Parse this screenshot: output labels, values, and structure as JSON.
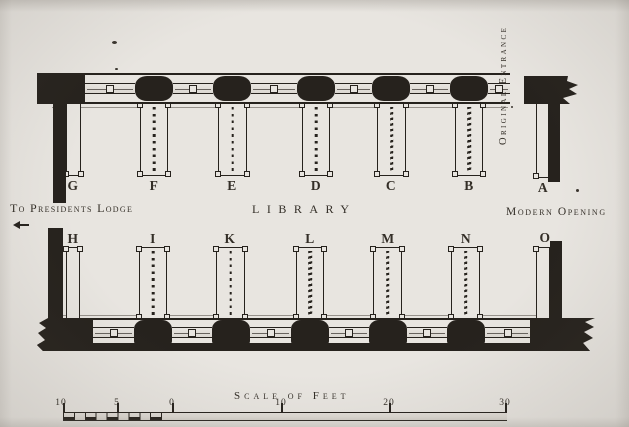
{
  "labels": {
    "original_entrance": "Original Entrance",
    "to_presidents_lodge": "To Presidents Lodge",
    "library": "Library",
    "modern_opening": "Modern Opening"
  },
  "top_bays": [
    {
      "label": "G",
      "fill": "empty"
    },
    {
      "label": "F",
      "fill": "dotted"
    },
    {
      "label": "E",
      "fill": "dotted"
    },
    {
      "label": "D",
      "fill": "dotted"
    },
    {
      "label": "C",
      "fill": "wavy"
    },
    {
      "label": "B",
      "fill": "wavy"
    },
    {
      "label": "A",
      "fill": "empty"
    }
  ],
  "bottom_bays": [
    {
      "label": "H",
      "fill": "empty"
    },
    {
      "label": "I",
      "fill": "dotted"
    },
    {
      "label": "K",
      "fill": "dotted"
    },
    {
      "label": "L",
      "fill": "wavy"
    },
    {
      "label": "M",
      "fill": "wavy"
    },
    {
      "label": "N",
      "fill": "wavy"
    },
    {
      "label": "O",
      "fill": "empty"
    }
  ],
  "scale_bar": {
    "title": "Scale of Feet",
    "tick_labels": [
      "10",
      "5",
      "0",
      "10",
      "20",
      "30"
    ]
  },
  "colors": {
    "paper": "#e8e5e0",
    "ink": "#26221d"
  }
}
